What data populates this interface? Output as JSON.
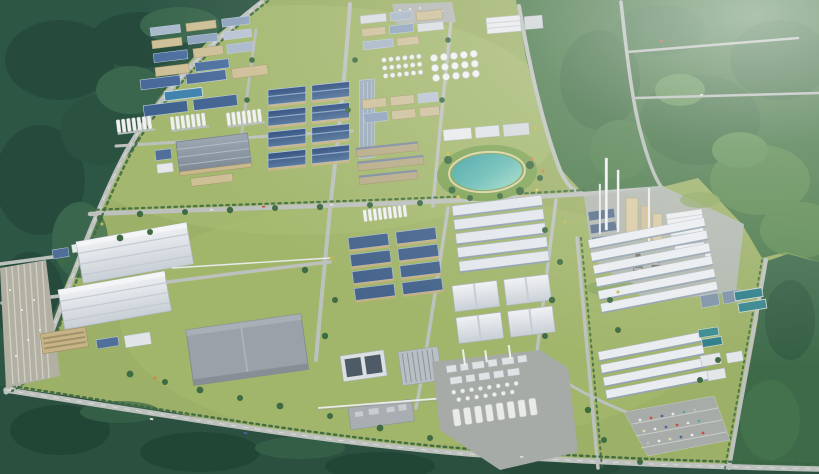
{
  "scene": {
    "description": "Aerial 3D rendering of a large industrial park masterplan surrounded by dense forest: factory districts with blue and white roofs, tank farms, a central landscaped teal lake, a cement plant with tall white smokestacks, a chemical plant with silo clusters, long white warehouse rows, tree-lined roads and parking lots",
    "view": "birds-eye perspective render, no text or UI elements",
    "environment": {
      "forest_cover": [
        "northwest dark wooded hills",
        "northeast woodland fading into white haze",
        "southern dark tree belt",
        "eastern tree belt"
      ],
      "water_features": [
        "central landscaped lake",
        "blue reservoir",
        "water treatment basins",
        "small pond"
      ]
    },
    "districts": [
      {
        "name": "northwest-factory-district",
        "features": [
          "blue metal roofs",
          "tan workshops",
          "silo rows",
          "blue reservoir"
        ]
      },
      {
        "name": "blue-warehouse-grid",
        "features": [
          "eight large dark-blue pitched roofs in two columns with tan walls"
        ]
      },
      {
        "name": "north-central-campus",
        "features": [
          "white office block",
          "round tank farm",
          "tan workshops"
        ]
      },
      {
        "name": "lake-park",
        "features": [
          "teal lake",
          "sandy path ring",
          "flower accents"
        ]
      },
      {
        "name": "southwest-logistics",
        "features": [
          "two giant white warehouses",
          "tan office block",
          "striped employee parking"
        ]
      },
      {
        "name": "gray-distribution-center",
        "features": [
          "large flat gray roof"
        ]
      },
      {
        "name": "south-central-blue-factories",
        "features": [
          "two columns of blue pitched roofs",
          "silo row",
          "pipe rack"
        ]
      },
      {
        "name": "white-shed-complex",
        "features": [
          "rows of striped white production halls"
        ]
      },
      {
        "name": "chemical-plant",
        "features": [
          "white distillation columns",
          "cylindrical silo row",
          "thin stacks"
        ]
      },
      {
        "name": "cement-plant",
        "features": [
          "tall white smokestacks",
          "tan preheater towers",
          "banded chimneys",
          "white warehouses",
          "dark panel rows"
        ]
      },
      {
        "name": "east-warehouse-rows",
        "features": [
          "long white sheds",
          "teal water treatment basins",
          "visitor parking with colored cars"
        ]
      }
    ],
    "palette": {
      "forest_dark": "#2e5645",
      "forest_light": "#4c7a4b",
      "park_grass": "#9cb067",
      "road": "#bdc1bd",
      "tree_line": "#406c41",
      "roof_blue": "#40628f",
      "roof_white": "#e9ecef",
      "roof_gray": "#9aa1a8",
      "wall_tan": "#c9b88c",
      "lake_teal": "#4fa9a8",
      "haze": "#ffffff"
    }
  }
}
